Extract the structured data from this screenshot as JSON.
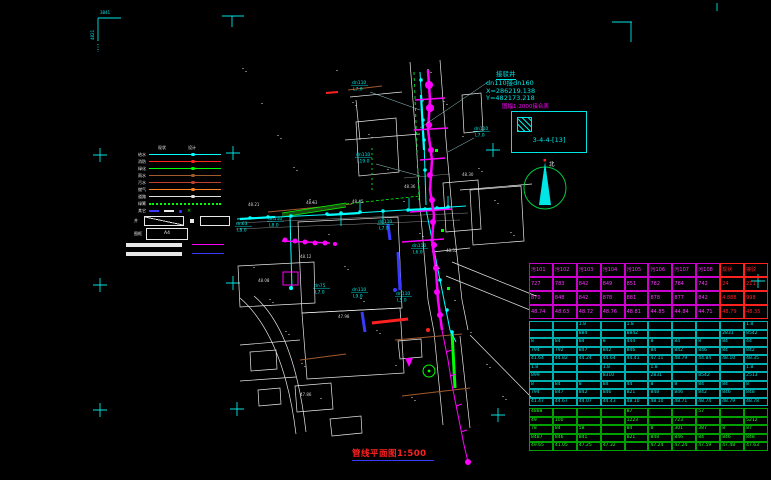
{
  "title": {
    "text": "管线平面图1:500"
  },
  "annotation": {
    "name": "接驳井",
    "pipe": "dn110接dn160",
    "x_coord": "X=286219.138",
    "y_coord": "Y=482173.218"
  },
  "sheet_index": {
    "note": "图幅1:2000接合表",
    "sheet_no": "3-4-4-[13]"
  },
  "north_arrow": {
    "label": "北"
  },
  "corner_text": {
    "top_left_h": "3841",
    "top_left_v": "4821"
  },
  "legend": {
    "col_headers": [
      "现状",
      "设计"
    ],
    "rows": [
      {
        "label": "给水",
        "color": "#00ffff",
        "style": "solid"
      },
      {
        "label": "消防",
        "color": "#ff2020",
        "style": "solid"
      },
      {
        "label": "绿化",
        "color": "#00ff00",
        "style": "solid"
      },
      {
        "label": "雨水",
        "color": "#a05a2c",
        "style": "solid"
      },
      {
        "label": "污水",
        "color": "#c04030",
        "style": "solid"
      },
      {
        "label": "燃气",
        "color": "#ff8020",
        "style": "solid"
      },
      {
        "label": "道路",
        "color": "#e0e0e0",
        "style": "solid"
      },
      {
        "label": "绿篱",
        "color": "#00ff00",
        "style": "dotted"
      }
    ],
    "symbol_row_label": "其它",
    "symbol_green_char": "×",
    "shape_row_label": "井",
    "a4_row_label": "图框",
    "a4_label": "A4",
    "note_line_colors": [
      "#ff00ff",
      "#3a3aff"
    ]
  },
  "map": {
    "callouts": [
      {
        "d": "dn110",
        "l": "L7.0",
        "x": 352,
        "y": 84
      },
      {
        "d": "dn110",
        "l": "L7.0",
        "x": 474,
        "y": 130
      },
      {
        "d": "dn110",
        "l": "L19.0",
        "x": 356,
        "y": 156
      },
      {
        "d": "dn63",
        "l": "L8.0",
        "x": 236,
        "y": 225
      },
      {
        "d": "dn110",
        "l": "L8.0",
        "x": 268,
        "y": 220
      },
      {
        "d": "dn110",
        "l": "L7.0",
        "x": 378,
        "y": 223
      },
      {
        "d": "dn75",
        "l": "L7.0",
        "x": 314,
        "y": 287
      },
      {
        "d": "dn110",
        "l": "L9.0",
        "x": 352,
        "y": 291
      },
      {
        "d": "dn110",
        "l": "L5.0",
        "x": 396,
        "y": 295
      },
      {
        "d": "dn110",
        "l": "L6.0",
        "x": 412,
        "y": 247
      }
    ],
    "spot_labels": [
      {
        "t": "48.21",
        "x": 248,
        "y": 206
      },
      {
        "t": "48.63",
        "x": 306,
        "y": 204
      },
      {
        "t": "48.45",
        "x": 352,
        "y": 203
      },
      {
        "t": "48.12",
        "x": 300,
        "y": 258
      },
      {
        "t": "47.98",
        "x": 338,
        "y": 318
      },
      {
        "t": "48.36",
        "x": 404,
        "y": 188
      },
      {
        "t": "48.52",
        "x": 446,
        "y": 252
      },
      {
        "t": "47.86",
        "x": 300,
        "y": 396
      },
      {
        "t": "48.08",
        "x": 258,
        "y": 282
      },
      {
        "t": "48.30",
        "x": 462,
        "y": 176
      }
    ]
  },
  "crosses": [
    [
      100,
      155
    ],
    [
      233,
      153
    ],
    [
      493,
      150
    ],
    [
      100,
      285
    ],
    [
      233,
      283
    ],
    [
      758,
      281
    ],
    [
      100,
      410
    ],
    [
      237,
      409
    ],
    [
      498,
      415
    ]
  ],
  "colors": {
    "registration": "#00e5e5",
    "water": "#00ffff",
    "sewer": "#ff00ff",
    "green_line": "#00ff00",
    "highlight_red": "#ff2020",
    "blue": "#3a3aff",
    "brown": "#a05a2c",
    "white_line": "#e8e8e8"
  },
  "table": {
    "section_a": {
      "rows": [
        [
          "污101",
          "污102",
          "污103",
          "污104",
          "污105",
          "污106",
          "污107",
          "污108",
          "现状",
          "接驳"
        ],
        [
          "727",
          "783",
          "842",
          "849",
          "851",
          "782",
          "784",
          "742",
          "24",
          "211"
        ],
        [
          "870",
          "848",
          "842",
          "878",
          "881",
          "878",
          "877",
          "842",
          "4.888",
          "998"
        ],
        [
          "48.74",
          "48.63",
          "48.72",
          "48.76",
          "48.81",
          "44.85",
          "44.84",
          "44.71",
          "48.79",
          "48.35"
        ]
      ],
      "highlight_cols": [
        8,
        9
      ]
    },
    "section_b": {
      "rows": [
        [
          "",
          "",
          "1.8",
          "",
          "1.8",
          "",
          "",
          "",
          "",
          "1.8"
        ],
        [
          "",
          "",
          "884",
          "",
          "8842",
          "",
          "",
          "",
          "2831",
          "8542"
        ],
        [
          "8",
          "84",
          "84",
          "8",
          "444",
          "8",
          "84",
          "8",
          "84",
          "44"
        ],
        [
          "794",
          "792",
          "847",
          "842",
          "846",
          "84",
          "842",
          "846",
          "84",
          "842"
        ],
        [
          "41.64",
          "44.82",
          "44.24",
          "44.64",
          "44.41",
          "47.11",
          "48.79",
          "44.84",
          "48.10",
          "48.35"
        ],
        [
          "1.8",
          "",
          "",
          "1.8",
          "",
          "1.8",
          "",
          "",
          "",
          "1.8"
        ],
        [
          "899",
          "",
          "",
          "8310",
          "",
          "2831",
          "",
          "8542",
          "",
          "2513"
        ],
        [
          "8",
          "84",
          "8",
          "84",
          "44",
          "8",
          "8",
          "84",
          "84",
          "8"
        ],
        [
          "794",
          "847",
          "842",
          "846",
          "821",
          "848",
          "846",
          "842",
          "846",
          "848"
        ],
        [
          "41.47",
          "44.67",
          "44.07",
          "44.43",
          "48.10",
          "48.10",
          "48.71",
          "48.74",
          "48.79",
          "48.78"
        ]
      ]
    },
    "section_c": {
      "rows": [
        [
          "4888",
          "",
          "",
          "",
          "87",
          "",
          "",
          "57",
          "",
          ""
        ],
        [
          "49",
          "100",
          "",
          "",
          "1223",
          "",
          "723",
          "",
          "",
          "5212"
        ],
        [
          "78",
          "84",
          "58",
          "",
          "84",
          "8",
          "301",
          "387",
          "8",
          "87"
        ],
        [
          "8487",
          "846",
          "841",
          "",
          "821",
          "848",
          "846",
          "84",
          "846",
          "848"
        ],
        [
          "49.65",
          "41.05",
          "47.25",
          "47.32",
          "",
          "47.24",
          "47.24",
          "47.59",
          "47.48",
          "47.63"
        ]
      ]
    }
  }
}
